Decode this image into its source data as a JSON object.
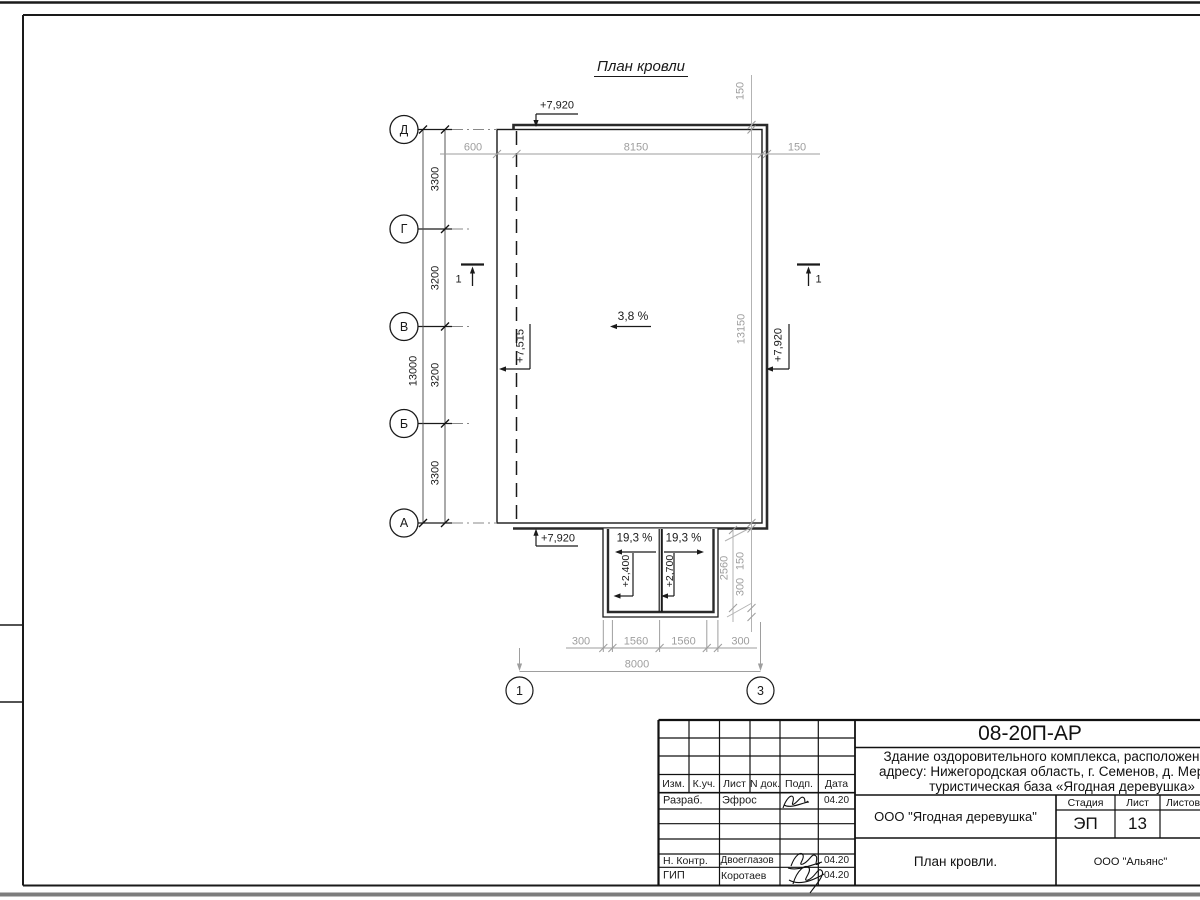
{
  "drawing": {
    "title": "План кровли",
    "slope_main": "3,8 %",
    "slope_porch_left": "19,3 %",
    "slope_porch_right": "19,3 %",
    "elev_top": "+7,920",
    "elev_left": "+7,515",
    "elev_right": "+7,920",
    "elev_bottom": "+7,920",
    "elev_porch_1": "+2,400",
    "elev_porch_2": "+2,700",
    "section_label": "1",
    "axes_rows": [
      "Д",
      "Г",
      "В",
      "Б",
      "А"
    ],
    "axes_cols": [
      "1",
      "3"
    ],
    "dims_left_segments": [
      "3300",
      "3200",
      "3200",
      "3300"
    ],
    "dim_left_total": "13000",
    "dims_top": [
      "600",
      "8150",
      "150"
    ],
    "dim_parapet": "150",
    "dim_right_total": "13150",
    "porch": {
      "dim_height": "2560",
      "dim_150": "150",
      "dim_300": "300"
    },
    "dims_bottom": [
      "300",
      "1560",
      "1560",
      "300"
    ],
    "dim_bottom_total": "8000"
  },
  "title_block": {
    "code": "08-20П-АР",
    "description_lines": [
      "Здание оздоровительного комплекса, расположенное по",
      "адресу: Нижегородская область, г. Семенов, д. Мериново,",
      "туристическая база «Ягодная деревушка»"
    ],
    "columns": [
      "Изм.",
      "К.уч.",
      "Лист",
      "N док.",
      "Подп.",
      "Дата"
    ],
    "rows": [
      {
        "role": "Разраб.",
        "name": "Эфрос",
        "date": "04.20"
      },
      {
        "role": "Н. Контр.",
        "name": "Двоеглазов",
        "date": "04.20"
      },
      {
        "role": "ГИП",
        "name": "Коротаев",
        "date": "04.20"
      }
    ],
    "org": "ООО \"Ягодная деревушка\"",
    "stage_label": "Стадия",
    "sheet_label": "Лист",
    "sheets_label": "Листов",
    "stage": "ЭП",
    "sheet": "13",
    "doc_title": "План кровли.",
    "company": "ООО \"Альянс\""
  }
}
